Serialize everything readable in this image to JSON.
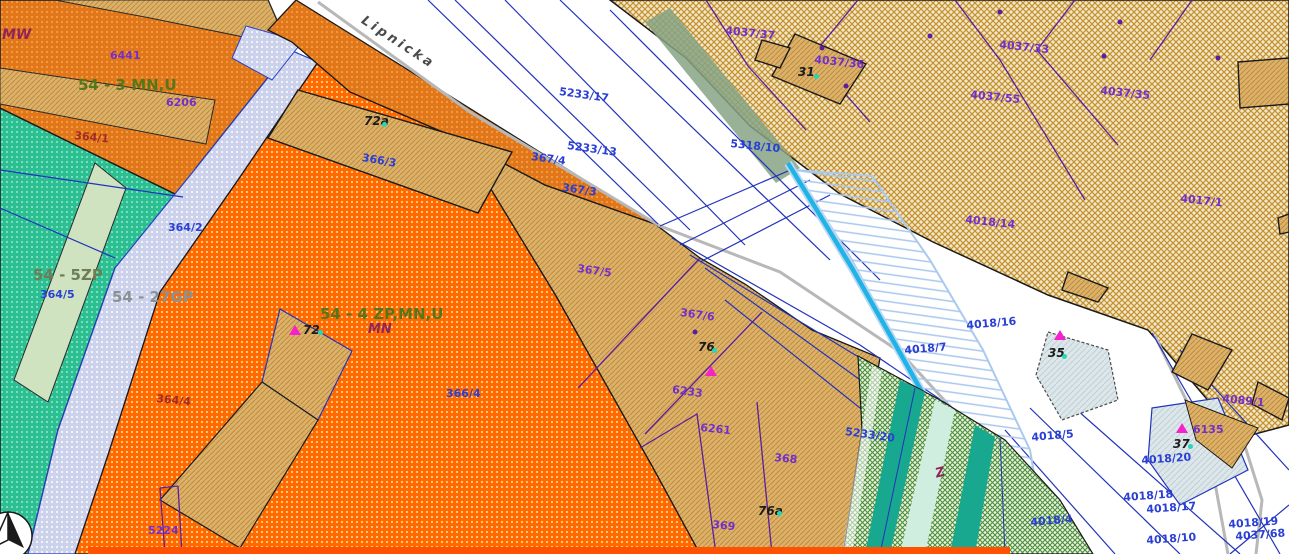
{
  "map": {
    "street": "Lipnicka",
    "zones": {
      "mw": "MW",
      "mnu3": "54 - 3 MN,U",
      "zp5": "54 - 5ZP",
      "gp27": "54 - 27GP",
      "zpmnu4": "54 - 4 ZP,MN,U",
      "mn": "MN",
      "z": "Z"
    },
    "addresses": {
      "a31": "31",
      "a35": "35",
      "a37": "37",
      "a72": "72",
      "a72a": "72a",
      "a76": "76",
      "a76a": "76a"
    },
    "parcels": {
      "p5233_17": "5233/17",
      "p5233_13": "5233/13",
      "p367_4": "367/4",
      "p367_3": "367/3",
      "p5318_10": "5318/10",
      "p366_3": "366/3",
      "p366_4": "366/4",
      "p364_1": "364/1",
      "p364_2": "364/2",
      "p364_4": "364/4",
      "p364_5": "364/5",
      "p6441": "6441",
      "p6206": "6206",
      "p5224": "5224",
      "p4037_37": "4037/37",
      "p4037_36": "4037/36",
      "p4037_33": "4037/33",
      "p4037_55": "4037/55",
      "p4037_35": "4037/35",
      "p4017_1": "4017/1",
      "p4018_14": "4018/14",
      "p4089_1": "4089/1",
      "p6135": "6135",
      "p6261": "6261",
      "p368": "368",
      "p369": "369",
      "p367_5": "367/5",
      "p367_6": "367/6",
      "p6233": "6233",
      "p5233_20": "5233/20",
      "p4018_16": "4018/16",
      "p4018_7": "4018/7",
      "p4018_5": "4018/5",
      "p4018_4": "4018/4",
      "p4018_20": "4018/20",
      "p4018_18": "4018/18",
      "p4018_17": "4018/17",
      "p4018_10": "4018/10",
      "p4018_19": "4018/19",
      "p4037_68": "4037/68"
    },
    "symbols": [
      "north-arrow-compass",
      "address-point-triangle",
      "address-point-dot",
      "utility-point-dot"
    ],
    "colors": {
      "zone_orange_dark": "#e2761a",
      "zone_orange_bright": "#ff6a00",
      "zone_teal": "#2bbf92",
      "zone_lavender": "#ccd2ec",
      "farmland_olive": "#c49130",
      "parcel_tan": "#dcb26a",
      "meadow_green": "#4a8f3f",
      "stream_cyan": "#1fb4e6",
      "flood_hatch_blue": "#a8c8ee",
      "boundary_red_strip": "#ff5100",
      "label_blue": "#2a3fd4",
      "label_purple": "#7330c8",
      "label_darkred": "#a02c28",
      "road_gray": "#b8b8b8"
    }
  }
}
